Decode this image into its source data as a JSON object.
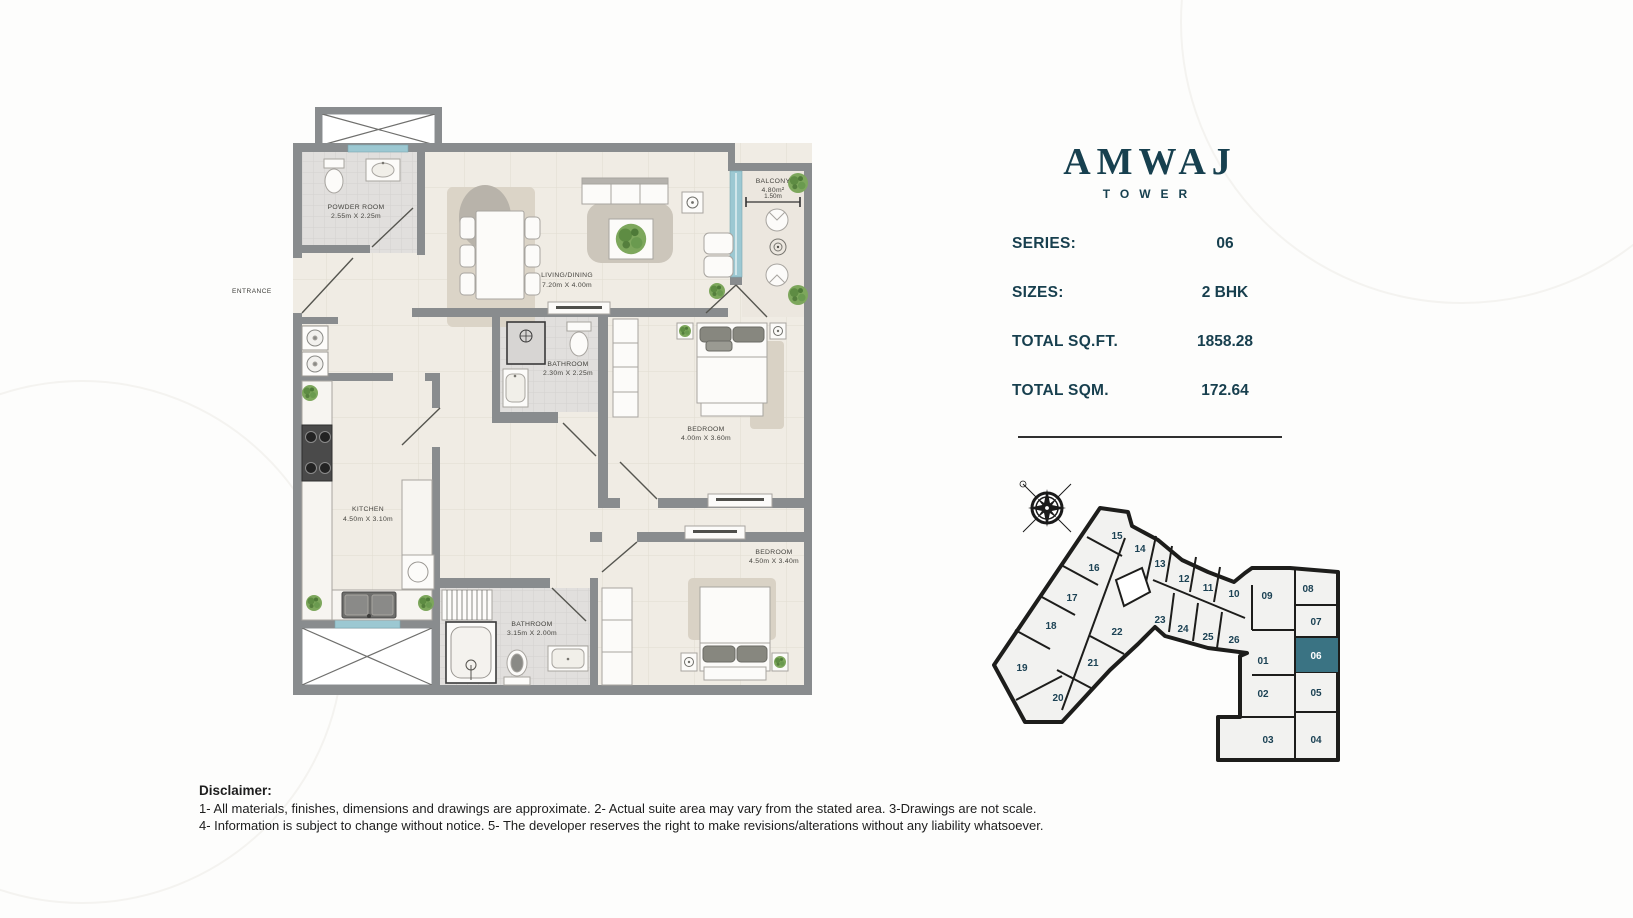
{
  "branding": {
    "name": "AMWAJ",
    "subtitle": "TOWER"
  },
  "details": {
    "rows": [
      {
        "label": "SERIES:",
        "value": "06"
      },
      {
        "label": "SIZES:",
        "value": "2 BHK"
      },
      {
        "label": "TOTAL SQ.FT.",
        "value": "1858.28"
      },
      {
        "label": "TOTAL SQM.",
        "value": "172.64"
      }
    ]
  },
  "floor_plan": {
    "entrance": "ENTRANCE",
    "rooms": [
      {
        "name": "POWDER ROOM",
        "dims": "2.55m X 2.25m"
      },
      {
        "name": "LIVING/DINING",
        "dims": "7.20m X 4.00m"
      },
      {
        "name": "BATHROOM",
        "dims": "2.30m X 2.25m"
      },
      {
        "name": "BEDROOM",
        "dims": "4.00m X 3.60m"
      },
      {
        "name": "KITCHEN",
        "dims": "4.50m X 3.10m"
      },
      {
        "name": "BATHROOM",
        "dims": "3.15m X 2.00m"
      },
      {
        "name": "BEDROOM",
        "dims": "4.50m X 3.40m"
      }
    ],
    "balcony": {
      "name": "BALCONY",
      "area": "4.80m²",
      "width_dim": "1.50m"
    }
  },
  "key_plan": {
    "highlighted_unit": "06",
    "units": [
      "01",
      "02",
      "03",
      "04",
      "05",
      "06",
      "07",
      "08",
      "09",
      "10",
      "11",
      "12",
      "13",
      "14",
      "15",
      "16",
      "17",
      "18",
      "19",
      "20",
      "21",
      "22",
      "23",
      "24",
      "25",
      "26"
    ]
  },
  "disclaimer": {
    "title": "Disclaimer:",
    "line1": "1- All materials, finishes, dimensions and drawings are approximate. 2- Actual suite area may vary from the stated area. 3-Drawings are not scale.",
    "line2": "4- Information is subject to change without notice. 5- The developer reserves the right to make revisions/alterations without any liability whatsoever."
  },
  "colors": {
    "brand_teal": "#17404f",
    "highlight_teal": "#3a7383",
    "wall_gray": "#898c8e",
    "glass_teal": "#9cc8d2"
  }
}
